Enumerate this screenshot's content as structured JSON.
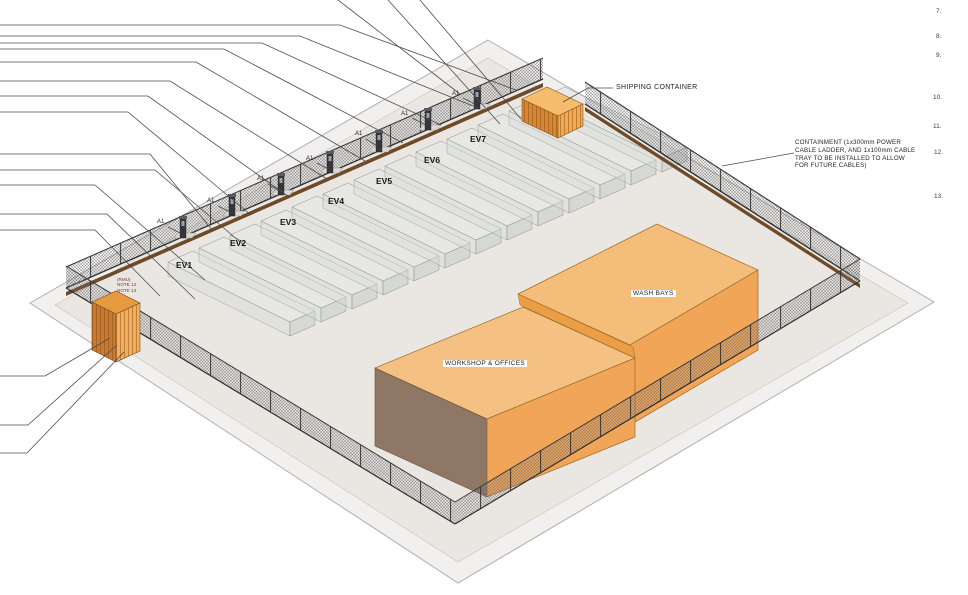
{
  "drawing": {
    "view": "3D isometric site plan",
    "labels": {
      "shipping_container": "SHIPPING CONTAINER",
      "containment_note": "CONTAINMENT (1x300mm POWER\nCABLE LADDER, AND 1x100mm CABLE\nTRAY TO BE INSTALLED TO ALLOW\nFOR FUTURE CABLES)",
      "wash_bays": "WASH BAYS",
      "workshop_offices": "WORKSHOP & OFFICES",
      "isolator_tag": "A1",
      "transformer_notes": "(RMU)\nNOTE 12\nNOTE 13"
    },
    "ev_chargers": [
      "EV1",
      "EV2",
      "EV3",
      "EV4",
      "EV5",
      "EV6",
      "EV7"
    ],
    "margin_numbers": [
      "7.",
      "8.",
      "9.",
      "10.",
      "11.",
      "12.",
      "13."
    ],
    "colors": {
      "roof_orange": "#f4c183",
      "wall_orange": "#f0a558",
      "divider_orange": "#ec9e45",
      "container_orange": "#e8933b",
      "shadow_face": "#8d7059",
      "slab_gray": "#edebe8",
      "fence_dark": "#3a3a3a",
      "cable_ladder_brown": "#6e4a26",
      "leader_line": "#4d4d4d"
    }
  }
}
